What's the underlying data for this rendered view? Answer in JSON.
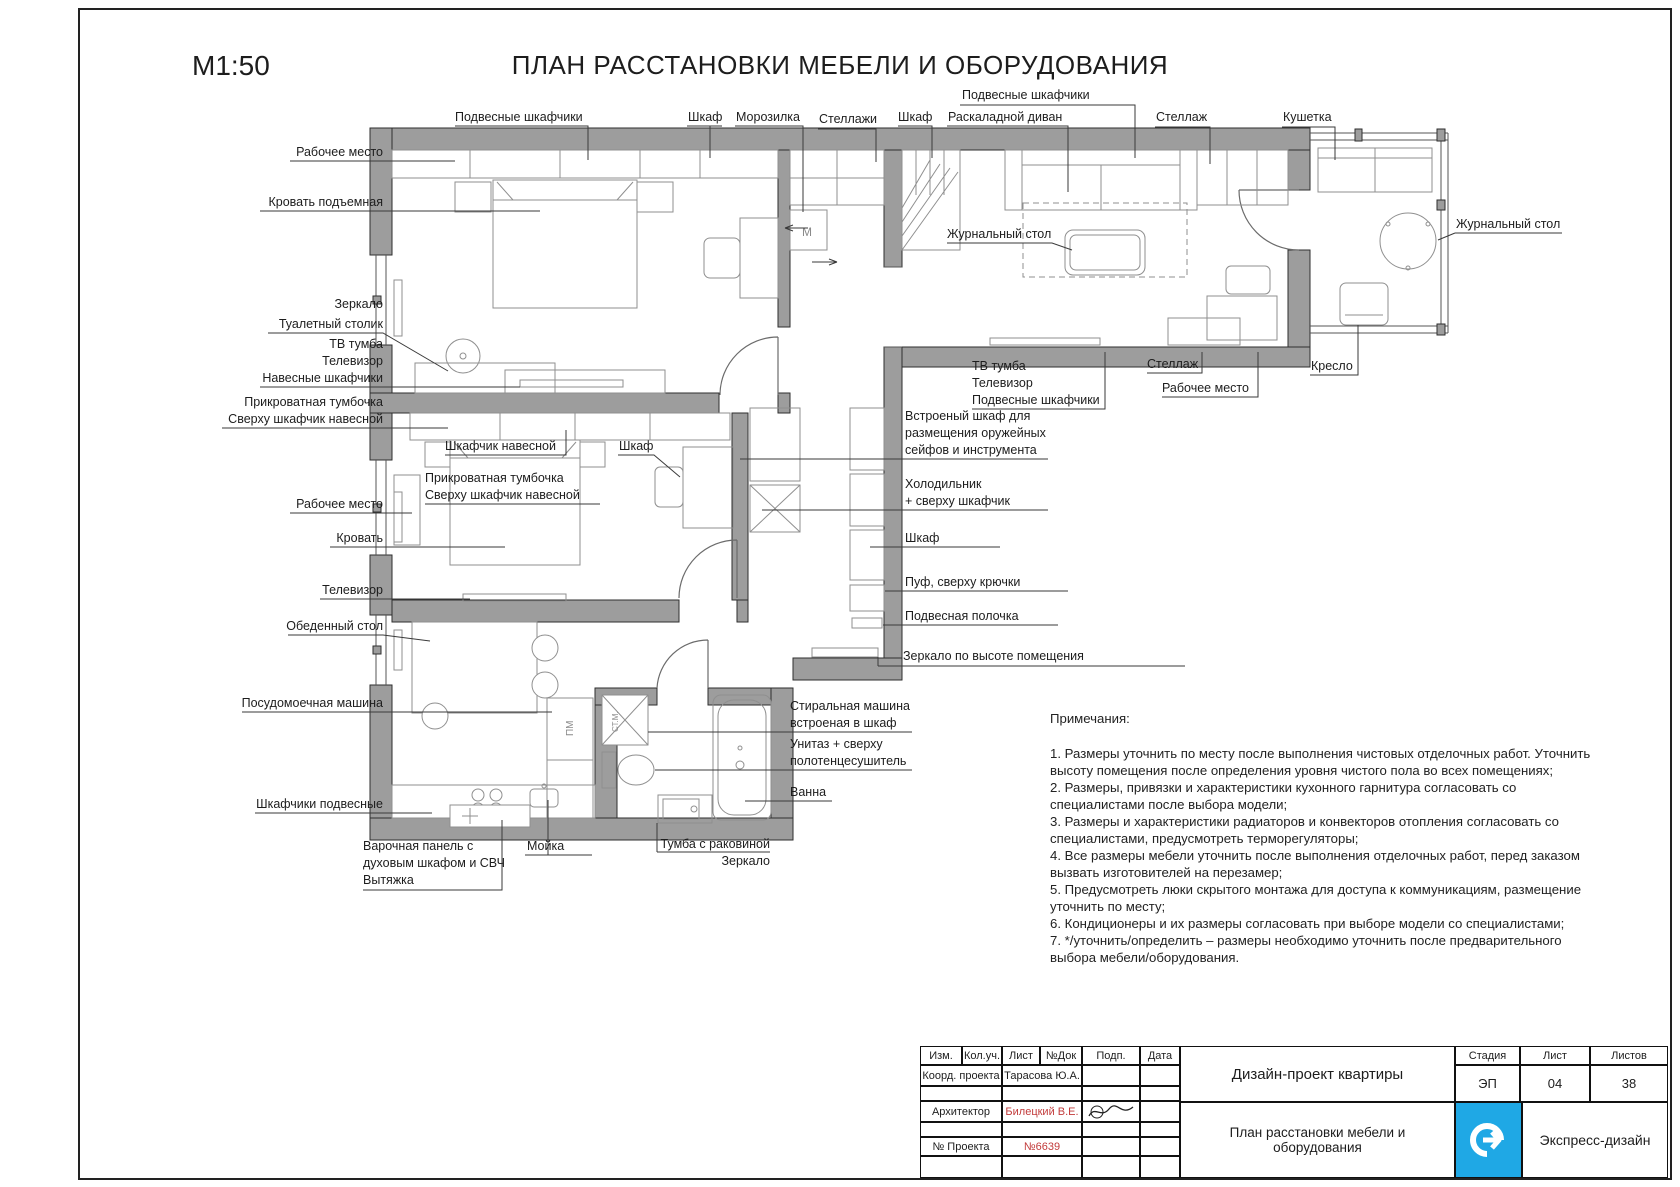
{
  "header": {
    "scale": "М1:50",
    "title": "ПЛАН РАССТАНОВКИ МЕБЕЛИ И ОБОРУДОВАНИЯ"
  },
  "labels": {
    "hanging_cabinets_1": "Подвесные шкафчики",
    "wardrobe_1": "Шкаф",
    "freezer": "Морозилка",
    "shelving_1": "Стеллажи",
    "wardrobe_2": "Шкаф",
    "folding_sofa": "Раскаладной диван",
    "hanging_cabinets_2": "Подвесные шкафчики",
    "shelving_2": "Стеллаж",
    "daybed": "Кушетка",
    "workplace_1": "Рабочее место",
    "lift_bed": "Кровать подъемная",
    "mirror_1": "Зеркало",
    "dressing_table": "Туалетный столик",
    "tv_stand_1": "ТВ тумба",
    "tv_1": "Телевизор",
    "wall_cabinets_1": "Навесные шкафчики",
    "bedside_1a": "Прикроватная тумбочка",
    "bedside_1b": "Сверху шкафчик навесной",
    "wall_cabinet_small": "Шкафчик навесной",
    "bedside_2a": "Прикроватная тумбочка",
    "bedside_2b": "Сверху шкафчик навесной",
    "wardrobe_3": "Шкаф",
    "workplace_2": "Рабочее место",
    "bed": "Кровать",
    "tv_2": "Телевизор",
    "dining_table": "Обеденный стол",
    "dishwasher": "Посудомоечная машина",
    "hanging_cabinets_3": "Шкафчики подвесные",
    "hob_1": "Варочная панель с",
    "hob_2": "духовым шкафом и СВЧ",
    "hood": "Вытяжка",
    "sink": "Мойка",
    "vanity": "Тумба с раковиной",
    "mirror_2": "Зеркало",
    "washer_1": "Стиральная машина",
    "washer_2": "встроеная в шкаф",
    "toilet_1": "Унитаз + сверху",
    "toilet_2": "полотенцесушитель",
    "bath": "Ванна",
    "coffee_table_1": "Журнальный стол",
    "coffee_table_2": "Журнальный стол",
    "tv_stand_2": "ТВ тумба",
    "tv_3": "Телевизор",
    "hanging_cabinets_4": "Подвесные шкафчики",
    "shelving_3": "Стеллаж",
    "workplace_3": "Рабочее место",
    "armchair": "Кресло",
    "builtin_1": "Встроеный шкаф для",
    "builtin_2": "размещения оружейных",
    "builtin_3": "сейфов и инструмента",
    "fridge_1": "Холодильник",
    "fridge_2": "+ сверху шкафчик",
    "wardrobe_4": "Шкаф",
    "pouf": "Пуф, сверху крючки",
    "wall_shelf": "Подвесная полочка",
    "mirror_full": "Зеркало по высоте помещения"
  },
  "plan_marks": {
    "freezer": "М",
    "dishwasher": "ПМ",
    "washer": "СТ.М."
  },
  "notes": {
    "title": "Примечания:",
    "items": [
      "1. Размеры уточнить по месту после выполнения чистовых отделочных работ. Уточнить высоту помещения после определения уровня чистого пола во всех помещениях;",
      "2. Размеры, привязки и характеристики кухонного гарнитура согласовать со специалистами после выбора модели;",
      "3. Размеры и характеристики радиаторов и конвекторов отопления согласовать со специалистами, предусмотреть терморегуляторы;",
      "4. Все размеры мебели уточнить после выполнения отделочных работ, перед заказом вызвать изготовителей на перезамер;",
      "5. Предусмотреть люки скрытого монтажа для доступа к коммуникациям, размещение уточнить по месту;",
      "6. Кондиционеры и их размеры согласовать при выборе модели со специалистами;",
      "7.  */уточнить/определить – размеры необходимо уточнить после предварительного выбора мебели/оборудования."
    ]
  },
  "titleblock": {
    "cols": [
      "Изм.",
      "Кол.уч.",
      "Лист",
      "№Док",
      "Подп.",
      "Дата"
    ],
    "row_coord_label": "Коорд. проекта",
    "row_coord_value": "Тарасова Ю.А.",
    "row_arch_label": "Архитектор",
    "row_arch_value": "Билецкий В.Е.",
    "row_proj_label": "№ Проекта",
    "row_proj_value": "№6639",
    "project": "Дизайн-проект квартиры",
    "sheet_title": "План расстановки мебели и оборудования",
    "stage_label": "Стадия",
    "sheet_label": "Лист",
    "sheets_label": "Листов",
    "stage": "ЭП",
    "sheet": "04",
    "sheets": "38",
    "company": "Экспресс-дизайн",
    "colors": {
      "wall": "#9d9d9d",
      "accent_red": "#c23b3b",
      "logo_blue": "#1fa8e5"
    }
  }
}
